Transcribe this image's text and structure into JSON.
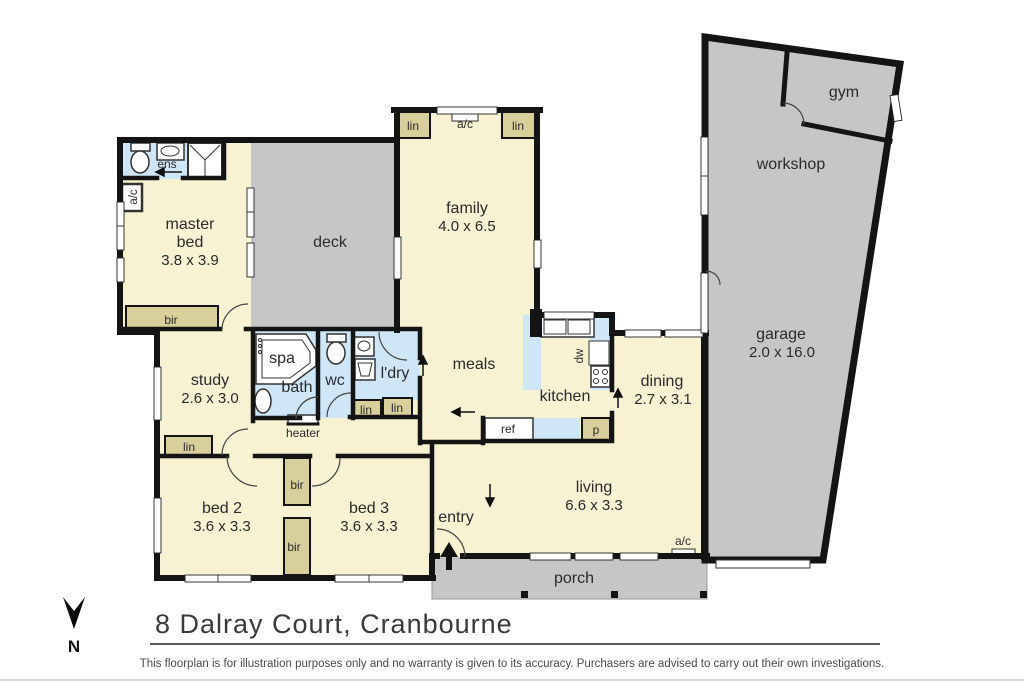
{
  "title": "8 Dalray Court, Cranbourne",
  "disclaimer": "This floorplan is for illustration purposes only and no warranty is given to its accuracy. Purchasers are advised to carry out their own investigations.",
  "compass": {
    "north": "N"
  },
  "colors": {
    "room_fill": "#f6f2d2",
    "wet_area_fill": "#cfe6f6",
    "closet_fill": "#d8d09b",
    "outdoor_fill": "#c6c6c6",
    "wall": "#141414"
  },
  "rooms": {
    "master_bed": {
      "name_line1": "master",
      "name_line2": "bed",
      "dims": "3.8 x 3.9"
    },
    "ens": {
      "name": "ens"
    },
    "deck": {
      "name": "deck"
    },
    "family": {
      "name": "family",
      "dims": "4.0 x 6.5"
    },
    "gym": {
      "name": "gym"
    },
    "workshop": {
      "name": "workshop"
    },
    "garage": {
      "name": "garage",
      "dims": "2.0 x 16.0"
    },
    "study": {
      "name": "study",
      "dims": "2.6 x 3.0"
    },
    "spa": {
      "name": "spa"
    },
    "bath": {
      "name": "bath"
    },
    "wc": {
      "name": "wc"
    },
    "ldry": {
      "name": "l'dry"
    },
    "meals": {
      "name": "meals"
    },
    "kitchen": {
      "name": "kitchen"
    },
    "dining": {
      "name": "dining",
      "dims": "2.7 x 3.1"
    },
    "bed2": {
      "name": "bed 2",
      "dims": "3.6 x 3.3"
    },
    "bed3": {
      "name": "bed 3",
      "dims": "3.6 x 3.3"
    },
    "entry": {
      "name": "entry"
    },
    "living": {
      "name": "living",
      "dims": "6.6 x 3.3"
    },
    "porch": {
      "name": "porch"
    }
  },
  "labels": {
    "bir": "bir",
    "lin": "lin",
    "ac": "a/c",
    "heater": "heater",
    "ref": "ref",
    "pantry": "p",
    "dw": "dw"
  }
}
